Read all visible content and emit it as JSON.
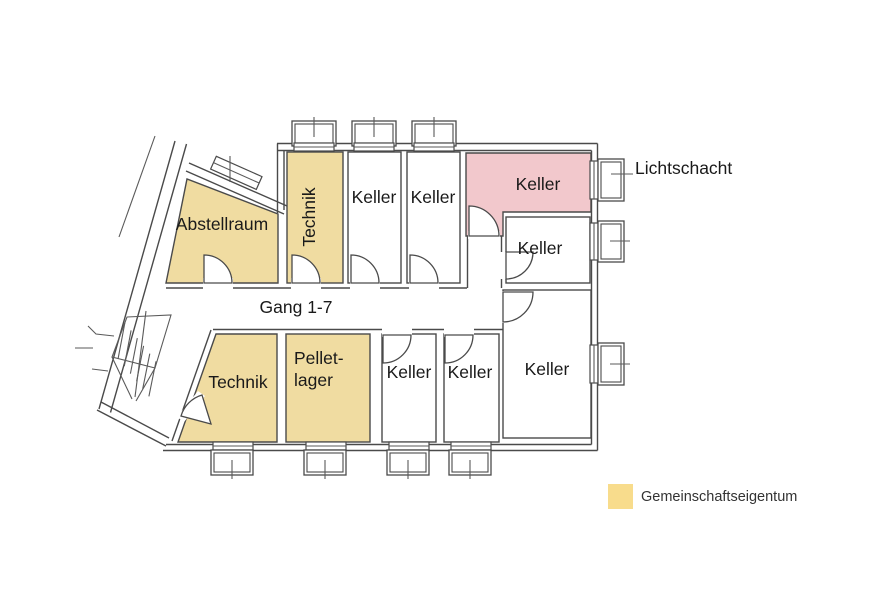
{
  "colors": {
    "common": "#F0DCA1",
    "highlight": "#F2C8CC",
    "legend_swatch": "#F8DC8C",
    "room_white": "#FFFFFF"
  },
  "rooms": [
    {
      "id": "abstellraum",
      "label": "Abstellraum",
      "fill": "#F0DCA1"
    },
    {
      "id": "technik-top",
      "label": "Technik",
      "fill": "#F0DCA1"
    },
    {
      "id": "keller-top-1",
      "label": "Keller",
      "fill": "#FFFFFF"
    },
    {
      "id": "keller-top-2",
      "label": "Keller",
      "fill": "#FFFFFF"
    },
    {
      "id": "keller-highlighted",
      "label": "Keller",
      "fill": "#F2C8CC"
    },
    {
      "id": "keller-mid-right",
      "label": "Keller",
      "fill": "#FFFFFF"
    },
    {
      "id": "keller-bottom-right",
      "label": "Keller",
      "fill": "#FFFFFF"
    },
    {
      "id": "technik-bottom",
      "label": "Technik",
      "fill": "#F0DCA1"
    },
    {
      "id": "pelletlager",
      "label": "Pellet-lager",
      "line1": "Pellet-",
      "line2": "lager",
      "fill": "#F0DCA1"
    },
    {
      "id": "keller-bottom-1",
      "label": "Keller",
      "fill": "#FFFFFF"
    },
    {
      "id": "keller-bottom-2",
      "label": "Keller",
      "fill": "#FFFFFF"
    }
  ],
  "corridor": {
    "label": "Gang 1-7"
  },
  "annotations": {
    "lichtschacht": "Lichtschacht"
  },
  "legend": {
    "label": "Gemeinschaftseigentum"
  }
}
